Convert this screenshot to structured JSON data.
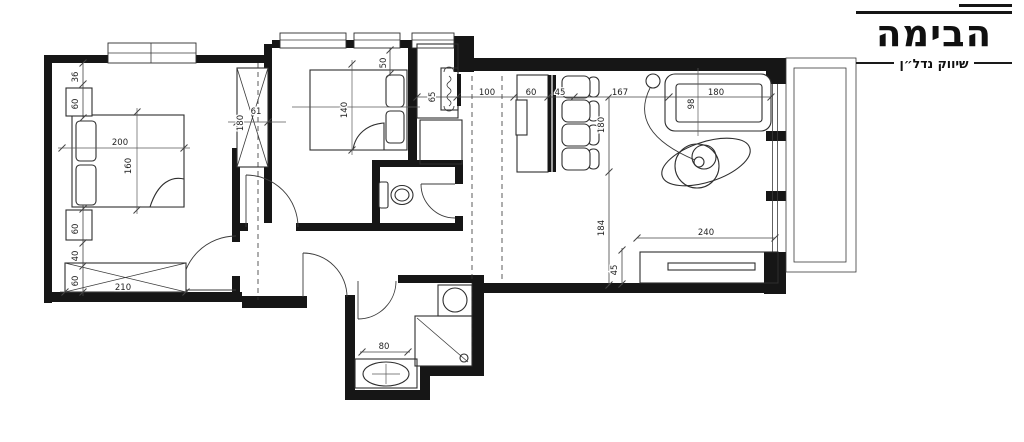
{
  "logo": {
    "title": "הבימה",
    "subtitle": "שיווק נדל״ן"
  },
  "dims": {
    "bedroom1": {
      "d36": "36",
      "d60a": "60",
      "d200": "200",
      "d160": "160",
      "d60b": "60",
      "d40": "40",
      "d60c": "60",
      "d210": "210"
    },
    "closet": {
      "d180": "180",
      "d61": "61"
    },
    "bedroom2": {
      "d140": "140",
      "d50": "50"
    },
    "corridor": {
      "d65": "65",
      "d100": "100",
      "d60": "60",
      "d45": "45"
    },
    "living": {
      "d167": "167",
      "d180_sofa": "180",
      "d98": "98",
      "d180": "180",
      "d184": "184",
      "d240": "240",
      "d45": "45"
    },
    "bathroom": {
      "d80": "80"
    }
  }
}
